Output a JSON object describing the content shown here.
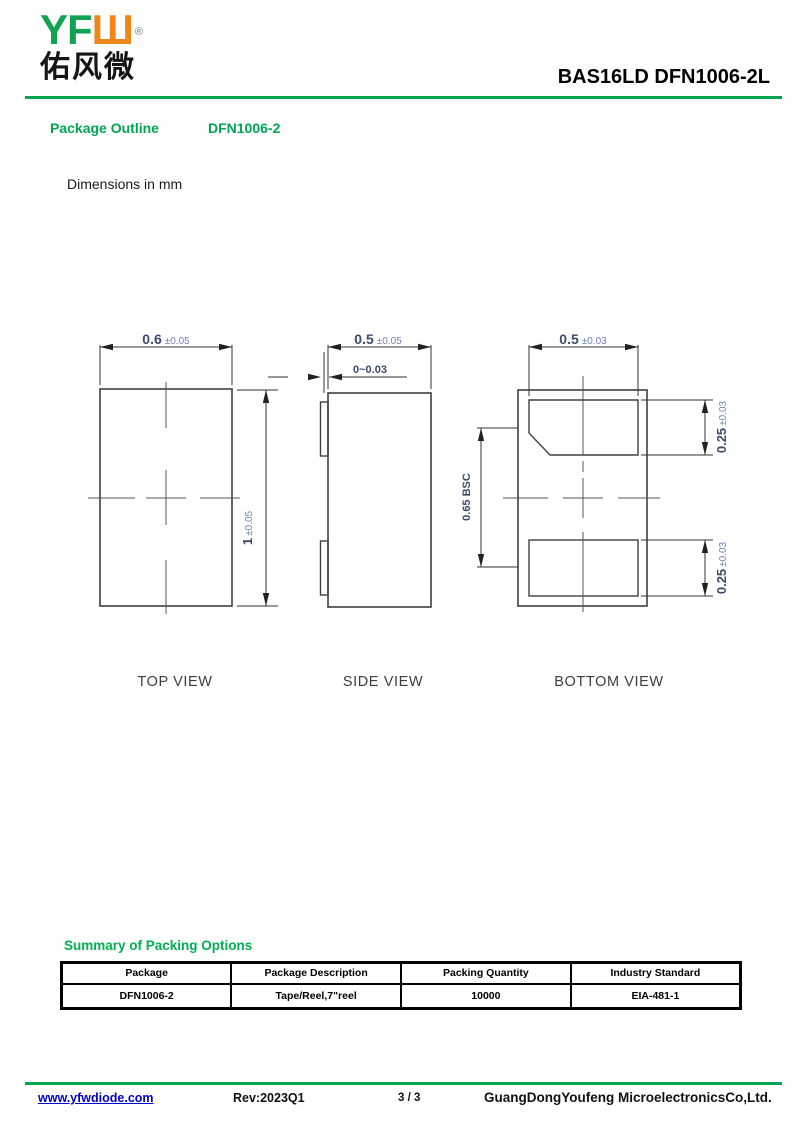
{
  "header": {
    "logo": {
      "yf": "YF",
      "w": "Ш",
      "registered": "®",
      "chinese": "佑风微"
    },
    "part_number": "BAS16LD DFN1006-2L"
  },
  "section": {
    "title": "Package Outline",
    "package": "DFN1006-2",
    "note": "Dimensions in mm"
  },
  "views": {
    "top": {
      "label": "TOP VIEW",
      "width": {
        "main": "0.6",
        "tol": "±0.05"
      },
      "height": {
        "main": "1",
        "tol": "±0.05"
      }
    },
    "side": {
      "label": "SIDE VIEW",
      "width": {
        "main": "0.5",
        "tol": "±0.05"
      },
      "standoff": "0~0.03"
    },
    "bottom": {
      "label": "BOTTOM VIEW",
      "width": {
        "main": "0.5",
        "tol": "±0.03"
      },
      "pitch": "0.65 BSC",
      "pad_top": {
        "main": "0.25",
        "tol": "±0.03"
      },
      "pad_bottom": {
        "main": "0.25",
        "tol": "±0.03"
      }
    }
  },
  "packing": {
    "title": "Summary of Packing Options",
    "columns": [
      "Package",
      "Package Description",
      "Packing Quantity",
      "Industry Standard"
    ],
    "rows": [
      [
        "DFN1006-2",
        "Tape/Reel,7\"reel",
        "10000",
        "EIA-481-1"
      ]
    ]
  },
  "footer": {
    "website": "www.yfwdiode.com",
    "revision": "Rev:2023Q1",
    "page_number": "3 / 3",
    "company": "GuangDongYoufeng MicroelectronicsCo,Ltd."
  },
  "colors": {
    "heading_green": "#00a551",
    "rule_green": "#00a651",
    "logo_green": "#12a352",
    "logo_orange": "#f08519",
    "link_blue": "#0000cc",
    "dim_text": "#3b4a6d",
    "dim_tolerance_text": "#6c82b4",
    "line": "#404040"
  }
}
